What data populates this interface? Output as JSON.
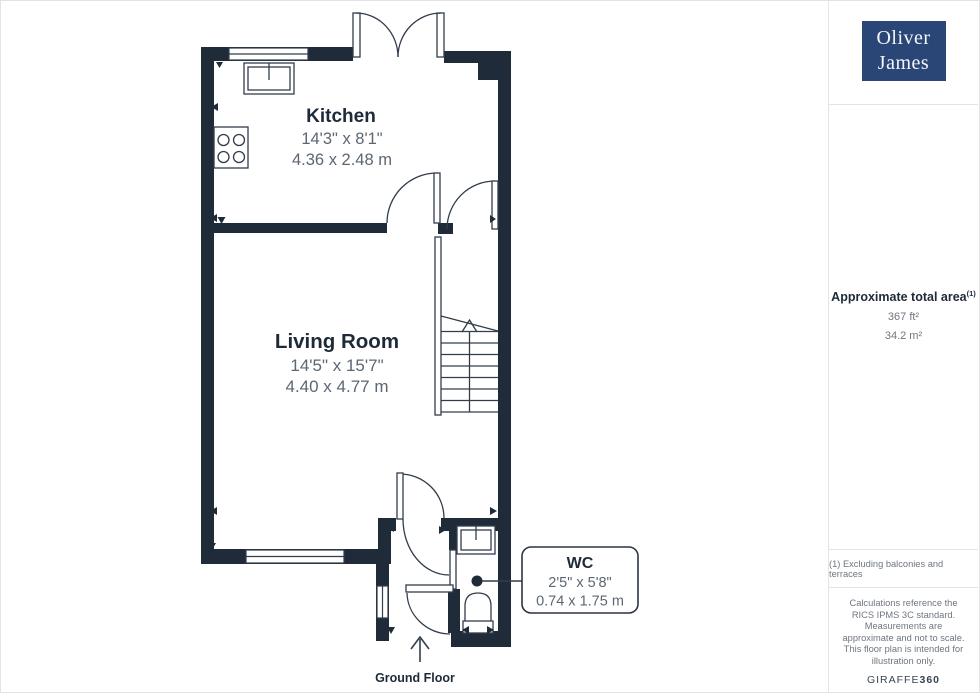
{
  "branding": {
    "logo_line1": "Oliver",
    "logo_line2": "James",
    "logo_background": "#2a4677"
  },
  "sidebar": {
    "area": {
      "title": "Approximate total area",
      "superscript": "(1)",
      "imperial": "367 ft²",
      "metric": "34.2 m²"
    },
    "footnote": "(1) Excluding balconies and terraces",
    "disclaimer": "Calculations reference the RICS IPMS 3C standard. Measurements are approximate and not to scale. This floor plan is intended for illustration only.",
    "watermark_brand": "GIRAFFE",
    "watermark_suffix": "360"
  },
  "floorplan": {
    "floor_label": "Ground Floor",
    "wall_color": "#202b3a",
    "line_color": "#323d4b",
    "rooms": [
      {
        "name": "Kitchen",
        "imperial": "14'3\" x 8'1\"",
        "metric": "4.36 x 2.48 m"
      },
      {
        "name": "Living Room",
        "imperial": "14'5\" x 15'7\"",
        "metric": "4.40 x 4.77 m"
      },
      {
        "name": "WC",
        "imperial": "2'5\" x 5'8\"",
        "metric": "0.74 x 1.75 m"
      }
    ]
  }
}
